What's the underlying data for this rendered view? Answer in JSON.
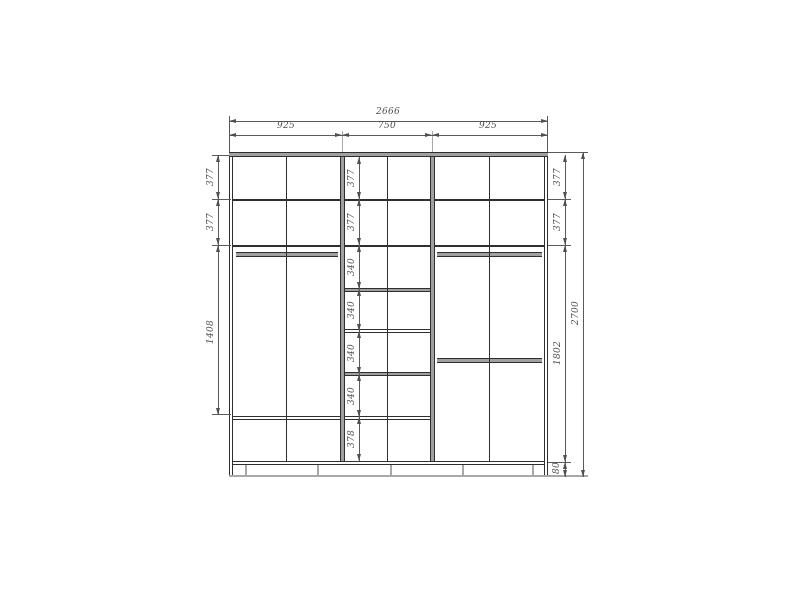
{
  "drawing": {
    "type": "wardrobe-interior-elevation",
    "dims": {
      "overall_width": "2666",
      "overall_height": "2700",
      "top_sections": [
        "925",
        "750",
        "925"
      ],
      "left_column": [
        "377",
        "377",
        "1408"
      ],
      "middle_column": [
        "377",
        "377",
        "340",
        "340",
        "340",
        "340",
        "378"
      ],
      "right_column": [
        "377",
        "377",
        "1802",
        "80"
      ]
    },
    "colors": {
      "structure_line": "#2f2f2f",
      "dimension_line": "#4f4f4f",
      "panel_fill": "#a0a0a0",
      "background": "#ffffff"
    }
  }
}
